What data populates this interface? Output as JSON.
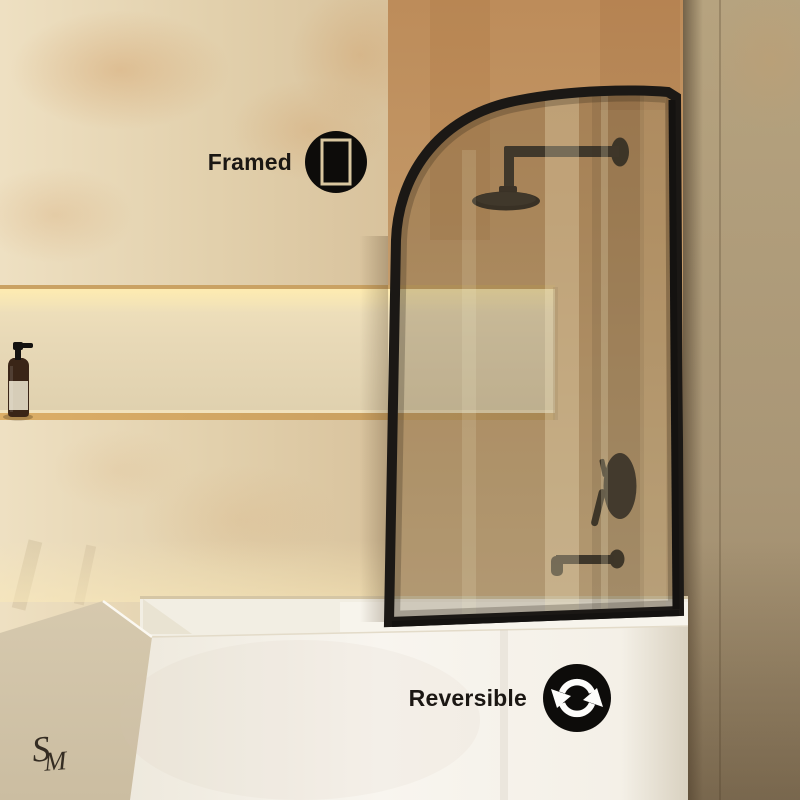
{
  "scene": {
    "description": "Bathroom product photo of a framed glass bathtub shower screen with curved top, black fixtures, travertine walls, lit wall niche with soap bottle, and white bathtub"
  },
  "features": [
    {
      "label": "Framed",
      "icon": "frame-icon"
    },
    {
      "label": "Reversible",
      "icon": "reversible-arrows-icon"
    }
  ],
  "logo": {
    "s": "S",
    "m": "M",
    "text": "SM"
  },
  "colors": {
    "frame_black": "#1b1815",
    "badge_black": "#0d0c0a",
    "wall_cream": "#e4d3b2",
    "wall_tan": "#c09464",
    "wall_right": "#ab9878",
    "niche_glow": "#f9e9bb",
    "tub_white": "#f7f4ed",
    "label_text": "#1b1713"
  }
}
